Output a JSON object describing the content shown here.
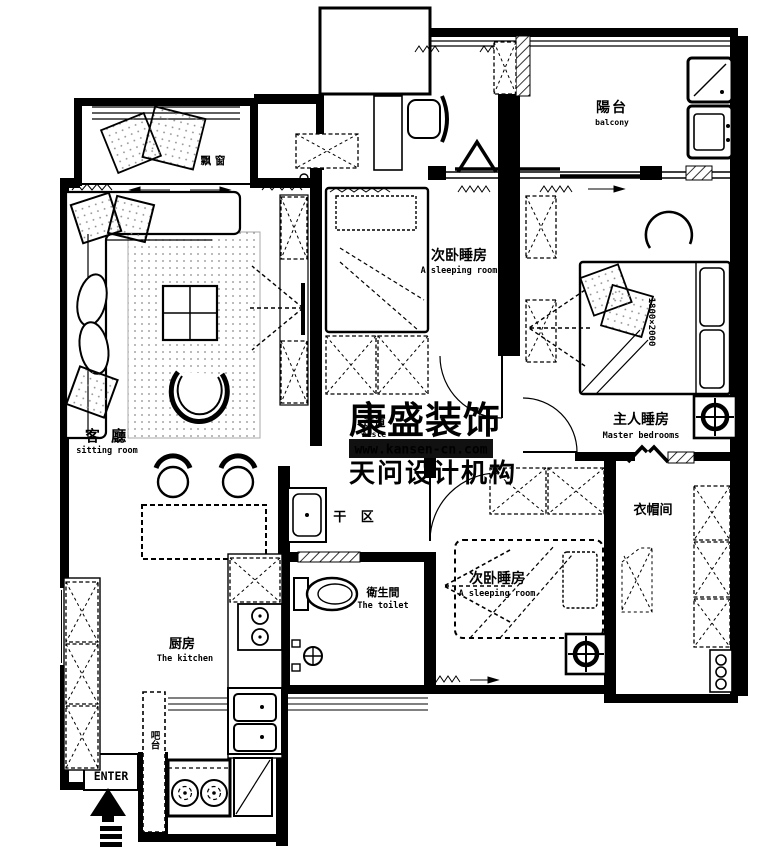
{
  "watermark": {
    "brand": "康盛装饰",
    "url": "www.kansen-cn.com",
    "org": "天问设计机构"
  },
  "labels": {
    "bay_window": "飘 窗",
    "balcony_zh": "陽台",
    "balcony_en": "balcony",
    "bedroom_a_zh": "次卧睡房",
    "bedroom_a_en": "A sleeping room",
    "master_zh": "主人睡房",
    "master_en": "Master bedrooms",
    "living_zh": "客 廳",
    "living_en": "sitting room",
    "aisle_zh": "过道",
    "aisle_en": "Aisle",
    "dry_zh": "干 区",
    "toilet_zh": "衛生間",
    "toilet_en": "The toilet",
    "bedroom_b_zh": "次卧睡房",
    "bedroom_b_en": "A sleeping room",
    "cloak_zh": "衣帽间",
    "kitchen_zh": "厨房",
    "kitchen_en": "The kitchen",
    "bar_zh": "吧台",
    "enter": "ENTER",
    "bed_size": "1800×2000"
  },
  "colors": {
    "ink": "#000000",
    "watermark_gray": "#9a9a9a",
    "ribbon_bg": "#111111",
    "ribbon_text": "#ffffff"
  }
}
